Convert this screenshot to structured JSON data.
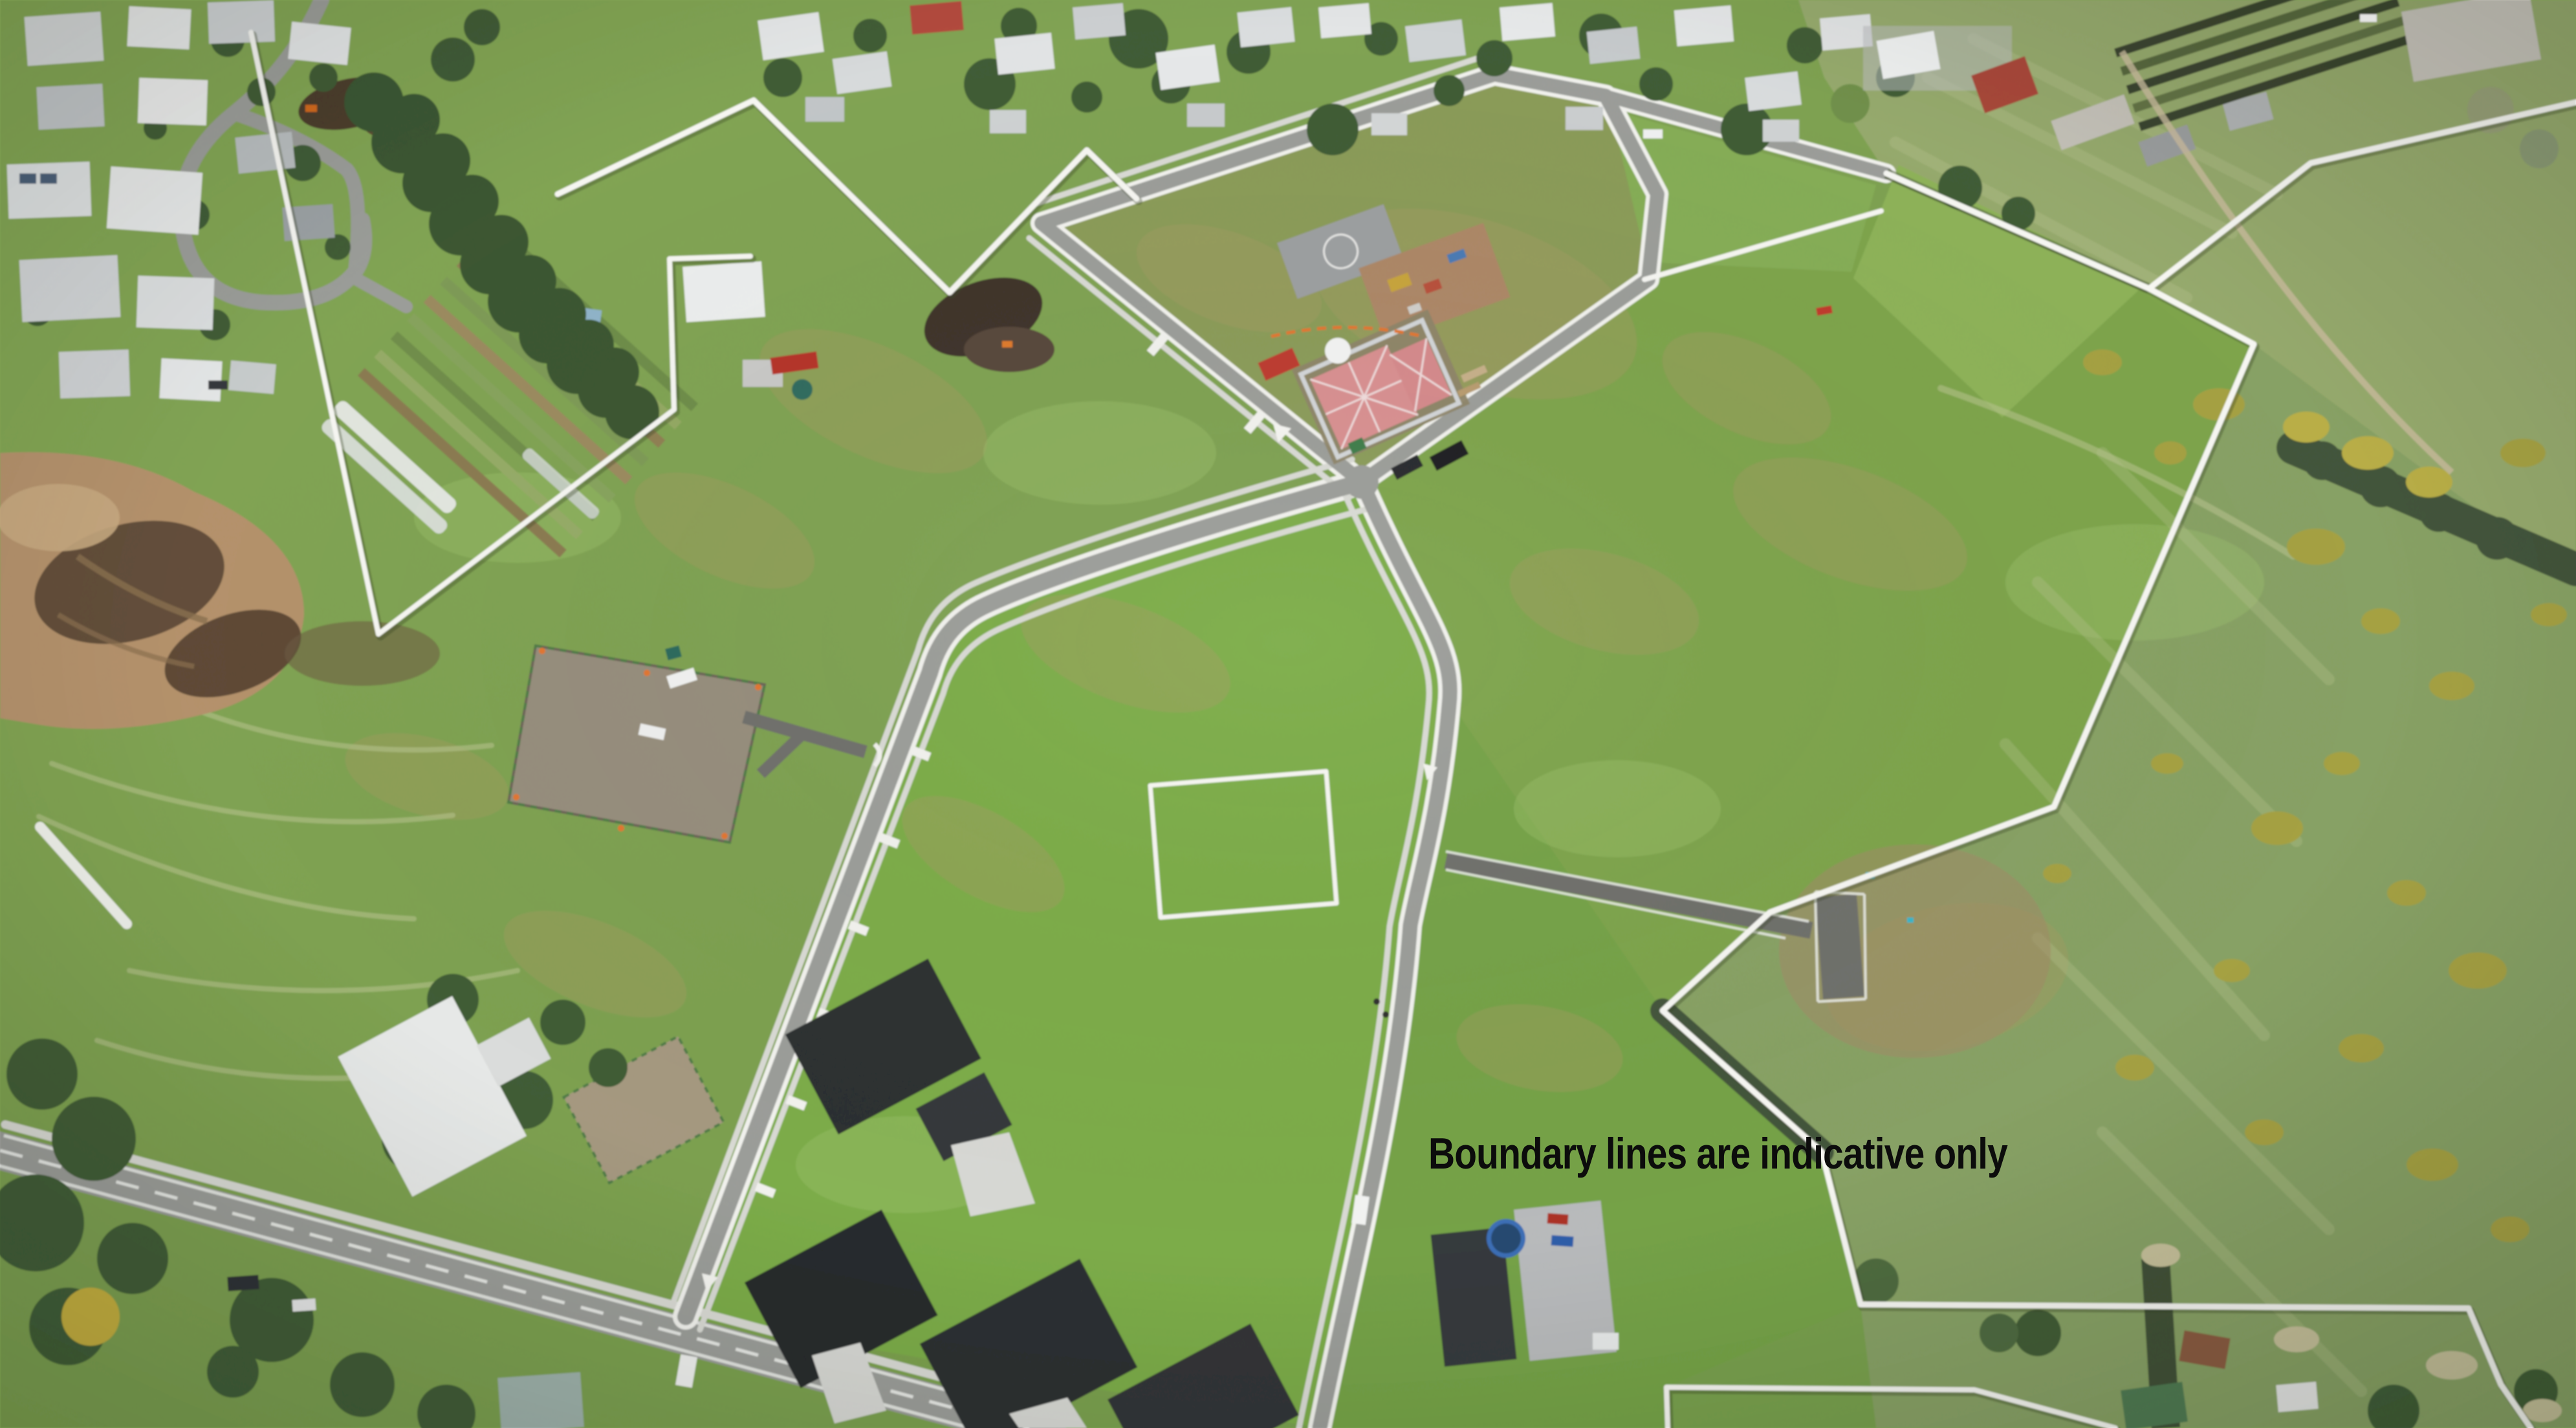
{
  "overlay": {
    "disclaimer": "Boundary lines are indicative only"
  },
  "scene": {
    "type": "aerial-drone-photo",
    "subject": "residential land subdivision with indicative white boundary lines, new kerbed roads, vacant grass lots, a house under construction, existing suburb at top and farmland at right"
  },
  "palette": {
    "grass_base": "#7ca04f",
    "grass_bright": "#7bac47",
    "grass_olive": "#8a9b58",
    "grass_sage": "#95a96c",
    "grass_dev": "#7da44b",
    "kerb": "#f3f3ef",
    "boundary": "#f7f7f3",
    "asphalt": "#9b9d99",
    "asphalt_dark": "#6e6f6b",
    "footpath": "#dadbd5",
    "dirt_tan": "#b4916b",
    "dirt_dark": "#594634",
    "pad_gravel": "#968d7c",
    "tree": "#3f5b35",
    "conifer": "#3a5531",
    "hedge": "#42533a",
    "gorse": "#a5a142",
    "truss_pink": "#d98f90",
    "scaffold": "#d3d6d8",
    "safety_orange": "#e2762f",
    "text": "#0c0c0c"
  }
}
